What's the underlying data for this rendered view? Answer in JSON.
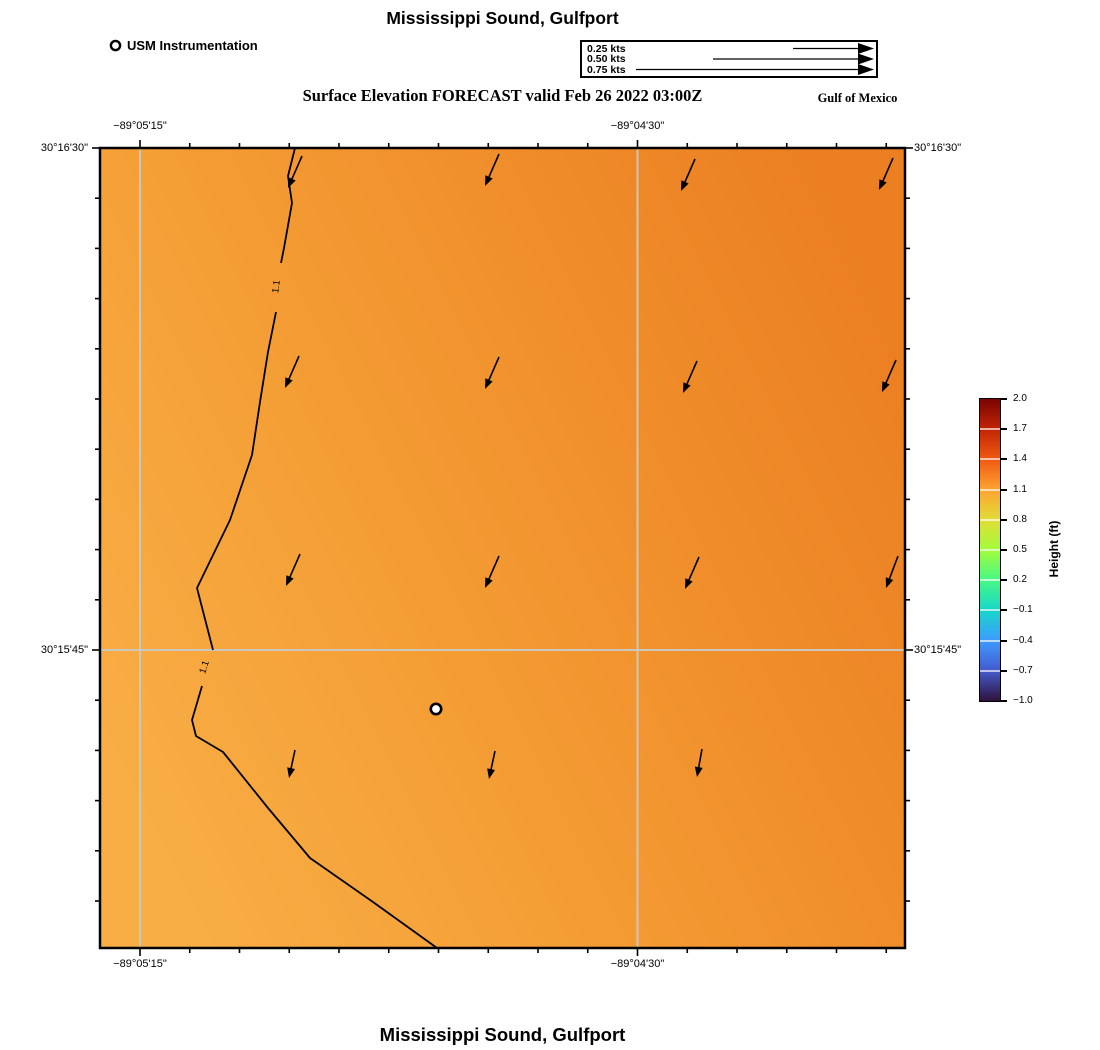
{
  "titles": {
    "top": "Mississippi Sound, Gulfport",
    "subtitle": "Surface Elevation FORECAST valid Feb 26 2022 03:00Z",
    "region": "Gulf of Mexico",
    "bottom": "Mississippi Sound, Gulfport"
  },
  "station_legend": {
    "label": "USM Instrumentation"
  },
  "velocity_legend": {
    "rows": [
      {
        "label": "0.25 kts",
        "speed_kts": 0.25
      },
      {
        "label": "0.50 kts",
        "speed_kts": 0.5
      },
      {
        "label": "0.75 kts",
        "speed_kts": 0.75
      }
    ]
  },
  "axes": {
    "x_tick_labels": [
      "−89°05'15\"",
      "−89°04'30\""
    ],
    "y_tick_labels": [
      "30°16'30\"",
      "30°15'45\""
    ]
  },
  "colorbar": {
    "title": "Height (ft)",
    "max": 2.0,
    "min": -1.0,
    "tick_labels": [
      "2.0",
      "1.7",
      "1.4",
      "1.1",
      "0.8",
      "0.5",
      "0.2",
      "−0.1",
      "−0.4",
      "−0.7",
      "−1.0"
    ],
    "colormap": "turbo"
  },
  "colors": {
    "map_gradient": [
      [
        "0%",
        "#F8AE45"
      ],
      [
        "40%",
        "#F49C34"
      ],
      [
        "75%",
        "#EF8B29"
      ],
      [
        "100%",
        "#EB7F22"
      ]
    ],
    "turbo_stops_bottom_to_top": [
      [
        "0%",
        "#30123B"
      ],
      [
        "10%",
        "#445ACD"
      ],
      [
        "20%",
        "#3E9BFE"
      ],
      [
        "30%",
        "#18D6CB"
      ],
      [
        "40%",
        "#46F884"
      ],
      [
        "50%",
        "#A2FC3C"
      ],
      [
        "60%",
        "#E1DD37"
      ],
      [
        "70%",
        "#FEA331"
      ],
      [
        "80%",
        "#EF5A11"
      ],
      [
        "90%",
        "#C22403"
      ],
      [
        "100%",
        "#7A0403"
      ]
    ],
    "gridline": "#CBC7BC",
    "contour": "#000000",
    "border": "#000000",
    "arrow": "#000000",
    "station_fill": "#FFFFFF"
  },
  "chart_data": {
    "type": "heatmap",
    "title": "Mississippi Sound, Gulfport — Surface Elevation FORECAST valid Feb 26 2022 03:00Z",
    "valid_time": "Feb 26 2022 03:00Z",
    "region_note": "Gulf of Mexico",
    "x_tick_labels": [
      "−89°05'15\"",
      "−89°04'30\""
    ],
    "y_tick_labels": [
      "30°16'30\"",
      "30°15'45\""
    ],
    "colorbar_label": "Height (ft)",
    "colorbar_range": [
      -1.0,
      2.0
    ],
    "colorbar_tick_step": 0.3,
    "surface_height_field": "nearly uniform orange field, approx 1.0–1.3 ft, increasing toward the east",
    "contour": {
      "value": 1.1,
      "label": "1.1",
      "labels": [
        {
          "x": 279,
          "y": 287,
          "rot": -82
        },
        {
          "x": 207,
          "y": 668,
          "rot": -72
        }
      ],
      "segments": [
        [
          [
            295,
            148
          ],
          [
            288,
            176
          ],
          [
            292,
            203
          ],
          [
            284,
            248
          ],
          [
            281,
            263
          ]
        ],
        [
          [
            276,
            312
          ],
          [
            268,
            352
          ],
          [
            260,
            402
          ],
          [
            252,
            455
          ],
          [
            230,
            520
          ],
          [
            197,
            588
          ],
          [
            213,
            650
          ]
        ],
        [
          [
            202,
            686
          ],
          [
            192,
            720
          ],
          [
            196,
            736
          ],
          [
            223,
            752
          ],
          [
            268,
            808
          ],
          [
            310,
            858
          ],
          [
            373,
            902
          ],
          [
            437,
            948
          ]
        ]
      ]
    },
    "current_vectors": {
      "direction": "south-southwest (down and slightly left)",
      "arrows_px": [
        [
          302,
          156,
          288,
          188
        ],
        [
          499,
          154,
          485,
          186
        ],
        [
          695,
          159,
          681,
          191
        ],
        [
          893,
          158,
          879,
          190
        ],
        [
          299,
          356,
          285,
          388
        ],
        [
          499,
          357,
          485,
          389
        ],
        [
          697,
          361,
          683,
          393
        ],
        [
          896,
          360,
          882,
          392
        ],
        [
          300,
          554,
          286,
          586
        ],
        [
          499,
          556,
          485,
          588
        ],
        [
          699,
          557,
          685,
          589
        ],
        [
          898,
          556,
          886,
          588
        ],
        [
          295,
          750,
          289,
          778
        ],
        [
          495,
          751,
          489,
          779
        ],
        [
          702,
          749,
          697,
          777
        ]
      ]
    },
    "station": {
      "x_px": 436,
      "y_px": 709
    },
    "geom": {
      "map": {
        "x": 100,
        "y": 148,
        "w": 805,
        "h": 800
      },
      "gridlines": {
        "x": [
          140,
          637.5
        ],
        "y": [
          650
        ]
      },
      "xticks": {
        "start": 140,
        "step": 49.75,
        "count": 16,
        "major_every": 10
      },
      "yticks": {
        "start": 148,
        "step": 50.2,
        "count": 16,
        "major_every": 10
      },
      "xlabel_px": [
        140,
        637.5
      ],
      "ylabel_px": [
        148,
        650
      ],
      "top_label_y": 120,
      "bottom_label_y": 958,
      "left_label_right_edge": 88,
      "right_label_left_edge": 914,
      "velocity_legend": {
        "end_x": 292,
        "rows": [
          {
            "y": 6.5,
            "start": 211
          },
          {
            "y": 17,
            "start": 131
          },
          {
            "y": 27.5,
            "start": 54
          }
        ]
      },
      "colorbar": {
        "x": 979,
        "y": 398,
        "w": 20,
        "h": 302
      }
    }
  }
}
